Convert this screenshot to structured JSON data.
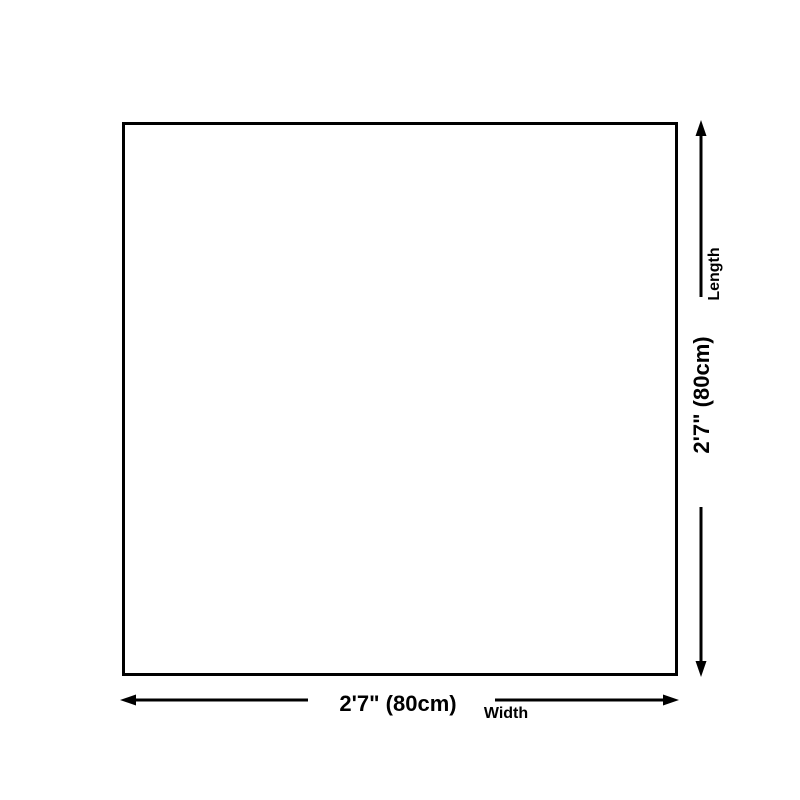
{
  "page": {
    "background_color": "#ffffff"
  },
  "diagram": {
    "shape": "square",
    "line_color": "#000000",
    "text_color": "#000000",
    "length_dimension": {
      "value": "2'7\" (80cm)",
      "label": "Length"
    },
    "width_dimension": {
      "value": "2'7\" (80cm)",
      "label": "Width"
    }
  }
}
